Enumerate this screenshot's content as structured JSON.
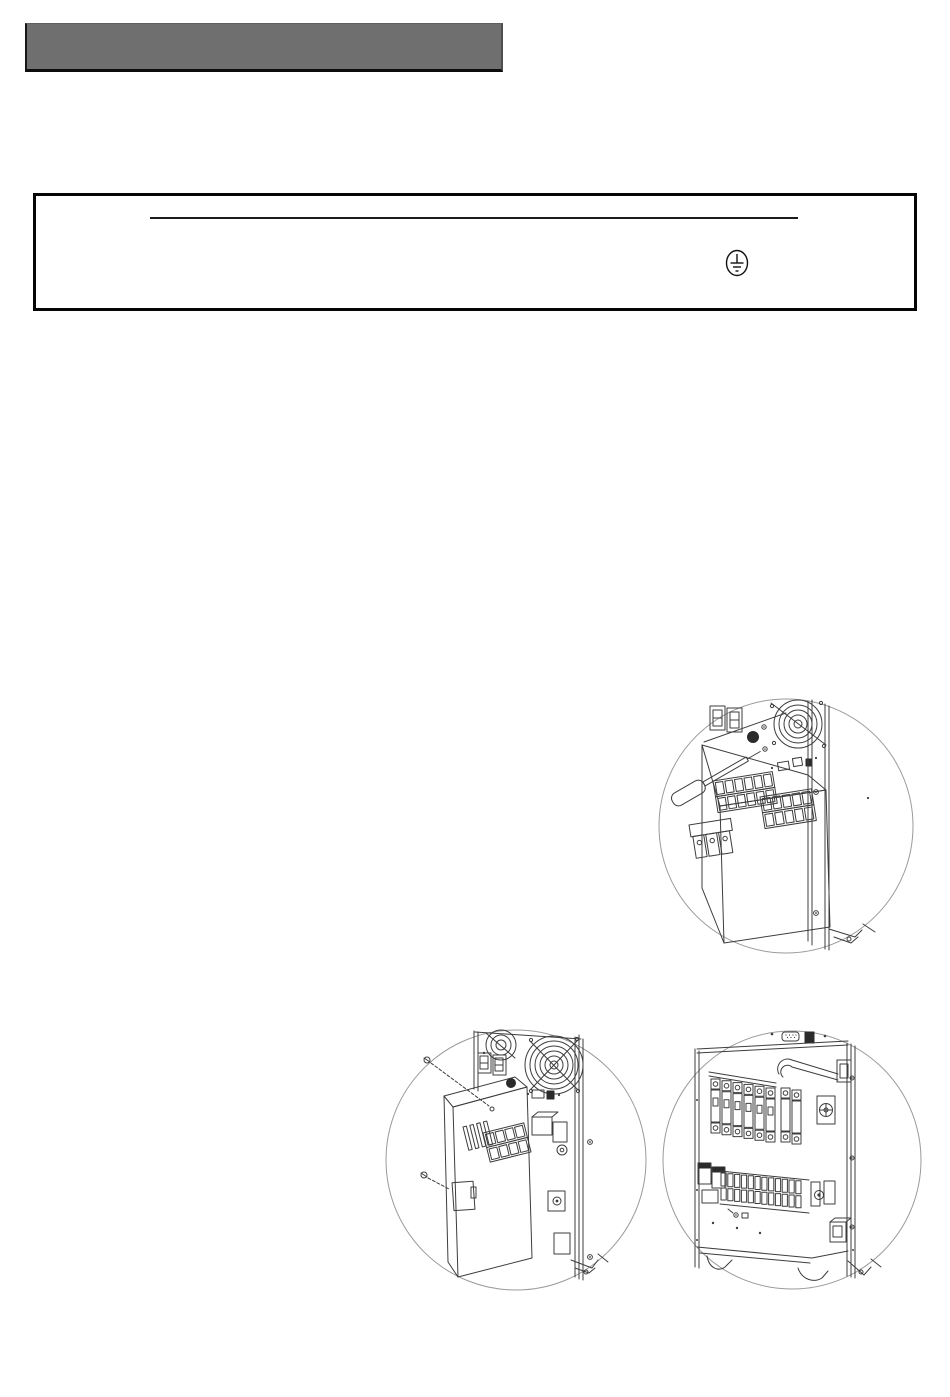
{
  "page": {
    "background_color": "#ffffff"
  },
  "header_bar": {
    "fill_color": "#6f6f6f",
    "edge_color": "#0d0d0d",
    "text": ""
  },
  "notice_box": {
    "border_color": "#050505",
    "heading_rule_color": "#1c1c1c",
    "icons": {
      "earth": "protective-earth-ground-icon"
    }
  },
  "figures": {
    "stroke_color": "#3d3d3d",
    "boundary_color": "#9a9a9a",
    "items": [
      {
        "icon": "ups-rear-cover-screwdriver-illustration"
      },
      {
        "icon": "ups-rear-cover-exploded-illustration"
      },
      {
        "icon": "ups-rear-terminal-blocks-illustration"
      }
    ]
  }
}
